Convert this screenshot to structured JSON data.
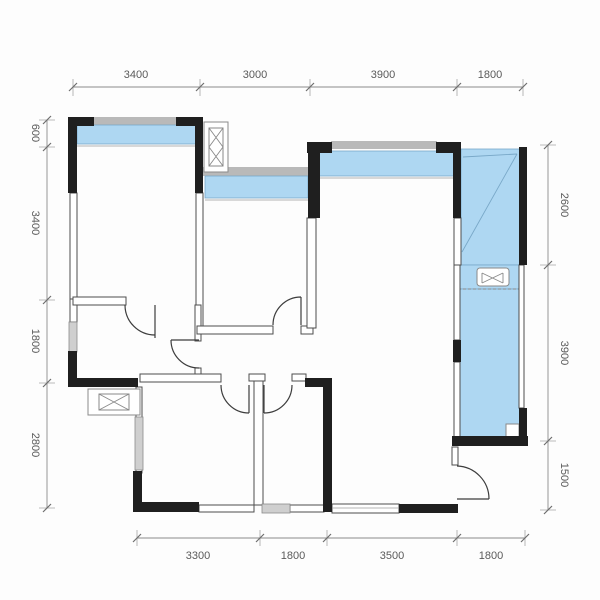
{
  "floorplan": {
    "dims": {
      "top": [
        "3400",
        "3000",
        "3900",
        "1800"
      ],
      "bottom": [
        "3300",
        "1800",
        "3500",
        "1800"
      ],
      "left": [
        "600",
        "3400",
        "1800",
        "2800"
      ],
      "right": [
        "2600",
        "3900",
        "1500"
      ]
    },
    "colors": {
      "wall": "#1f1f1f",
      "window": "#aed7f2",
      "outer_bar": "#b9b9b9"
    },
    "icons": {
      "flue_shaft": "flue-shaft-icon",
      "duct_shaft": "duct-shaft-icon",
      "ac_unit": "ac-unit-icon"
    }
  }
}
